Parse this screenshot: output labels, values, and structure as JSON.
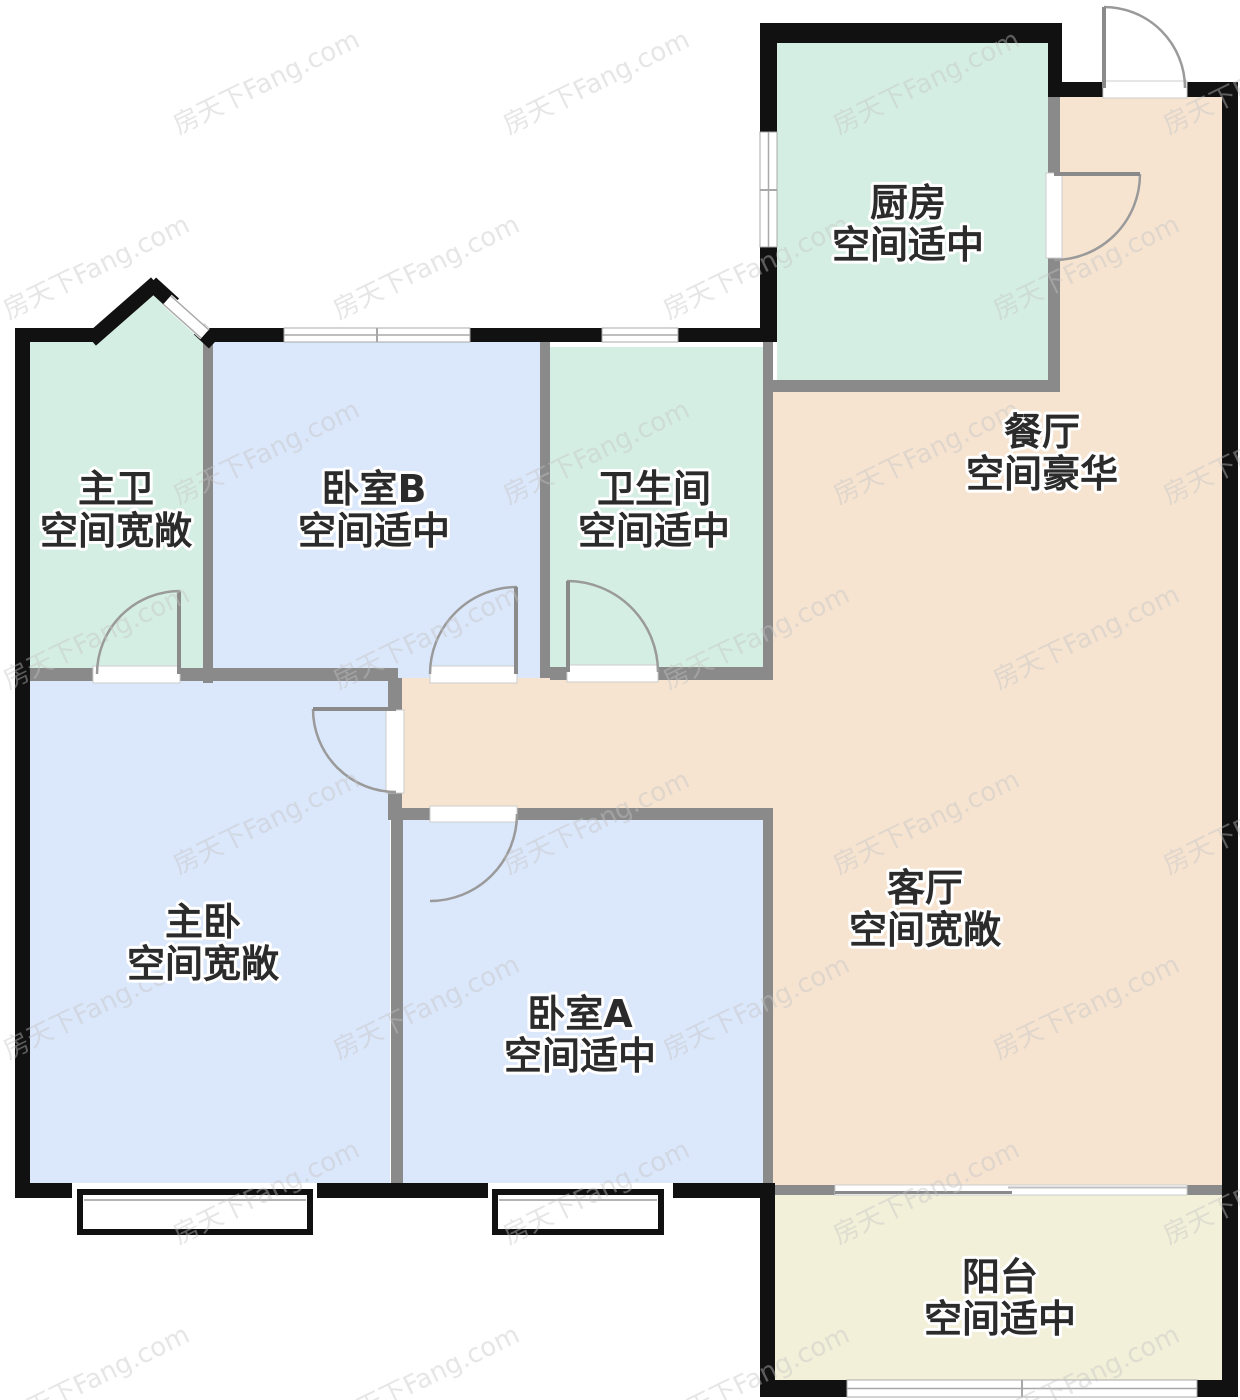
{
  "page": {
    "background": "#ffffff"
  },
  "watermark": {
    "text": "房天下Fang.com",
    "color": "#c4c4c4"
  },
  "palette": {
    "exterior_wall": "#111111",
    "interior_wall": "#8a8a8a",
    "door_arc": "#9a9a9a",
    "window_line": "#a8a8a8",
    "window_fill": "#ffffff",
    "label_text": "#2b2b2b",
    "label_halo": "#ffffff",
    "bath_green": "#d5eee3",
    "bedroom_blue": "#dbe7fa",
    "living_peach": "#f6e4d1",
    "balcony_cream": "#f2f0d9"
  },
  "rooms": [
    {
      "id": "master-bath",
      "name": "主卫",
      "quality": "空间宽敞",
      "color": "#d5eee3"
    },
    {
      "id": "bedroom-b",
      "name": "卧室B",
      "quality": "空间适中",
      "color": "#dbe7fa"
    },
    {
      "id": "bathroom",
      "name": "卫生间",
      "quality": "空间适中",
      "color": "#d5eee3"
    },
    {
      "id": "kitchen",
      "name": "厨房",
      "quality": "空间适中",
      "color": "#d5eee3"
    },
    {
      "id": "dining",
      "name": "餐厅",
      "quality": "空间豪华",
      "color": "#f6e4d1"
    },
    {
      "id": "living",
      "name": "客厅",
      "quality": "空间宽敞",
      "color": "#f6e4d1"
    },
    {
      "id": "master-bedroom",
      "name": "主卧",
      "quality": "空间宽敞",
      "color": "#dbe7fa"
    },
    {
      "id": "bedroom-a",
      "name": "卧室A",
      "quality": "空间适中",
      "color": "#dbe7fa"
    },
    {
      "id": "balcony",
      "name": "阳台",
      "quality": "空间适中",
      "color": "#f2f0d9"
    }
  ]
}
